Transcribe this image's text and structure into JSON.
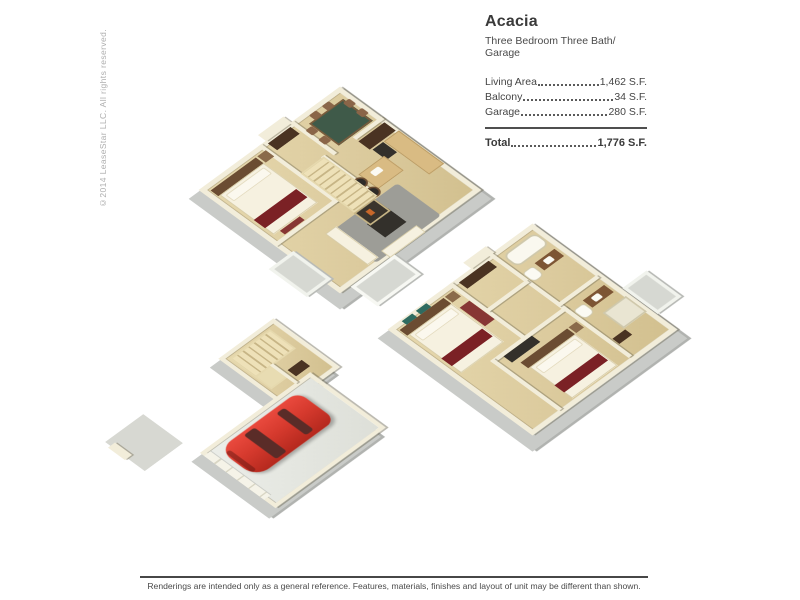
{
  "window": {
    "width": 800,
    "height": 600,
    "background": "#ffffff"
  },
  "copyright_vertical": "©2014 LeaseStar LLC. All rights reserved.",
  "header": {
    "title": "Acacia",
    "subtitle": "Three Bedroom Three Bath/ Garage"
  },
  "area_table": {
    "rows": [
      {
        "label": "Living Area",
        "value": "1,462 S.F."
      },
      {
        "label": "Balcony",
        "value": "34 S.F."
      },
      {
        "label": "Garage",
        "value": "280 S.F."
      }
    ],
    "total_label": "Total",
    "total_value": "1,776 S.F."
  },
  "floorplans": [
    {
      "id": "first-floor",
      "description": "3D isometric plan: bedroom, stairs, fireplace, dining, kitchen, living room, balconies"
    },
    {
      "id": "second-floor",
      "description": "3D isometric plan: two bedrooms, two bathrooms, closets, balcony"
    },
    {
      "id": "garage-level",
      "description": "3D isometric plan: garage with red car, staircase, entry walk"
    }
  ],
  "footer": {
    "disclaimer": "Renderings are intended only as a general reference. Features, materials, finishes and layout of unit may be different than shown."
  },
  "colors": {
    "floor_tan": "#dccb9e",
    "wall_cream": "#f2edda",
    "slab_gray": "#c9cbc8",
    "car_red": "#d63a2e",
    "bed_accent_red": "#7b2125",
    "text_dark": "#3a3a3a"
  }
}
